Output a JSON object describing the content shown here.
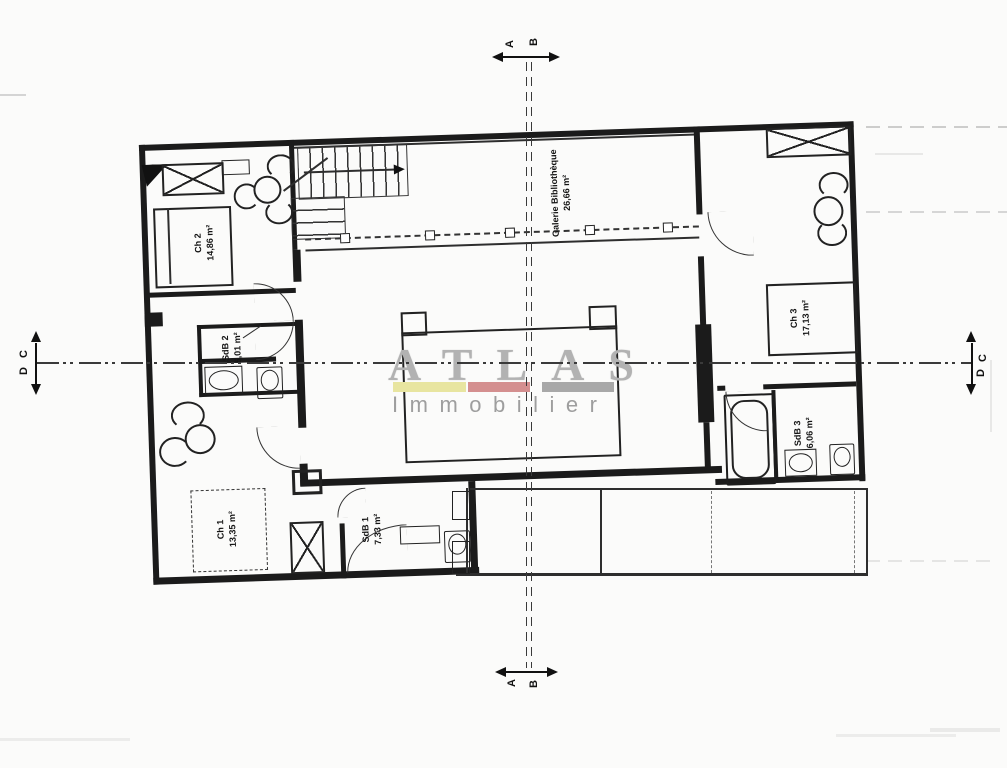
{
  "watermark": {
    "brand": "ATLAS",
    "subtitle": "Immobilier",
    "bar_colors": [
      "#e8e5a0",
      "#d48f8f",
      "#a8a8a8"
    ]
  },
  "rooms": {
    "ch2": {
      "name": "Ch 2",
      "area": "14,86 m²"
    },
    "galerie": {
      "name": "Galerie Bibliothèque",
      "area": "26,66 m²"
    },
    "ch3": {
      "name": "Ch 3",
      "area": "17,13 m²"
    },
    "sdb2": {
      "name": "SdB 2",
      "area": "5,01 m²"
    },
    "ch1": {
      "name": "Ch 1",
      "area": "13,35 m²"
    },
    "sdb1": {
      "name": "SdB 1",
      "area": "7,33 m²"
    },
    "sdb3": {
      "name": "SdB 3",
      "area": "6,06 m²"
    }
  },
  "markers": {
    "top": [
      "A",
      "B"
    ],
    "bottom": [
      "A",
      "B"
    ],
    "left": [
      "C",
      "D"
    ],
    "right": [
      "C",
      "D"
    ]
  },
  "line_color": "#1b1b1b"
}
